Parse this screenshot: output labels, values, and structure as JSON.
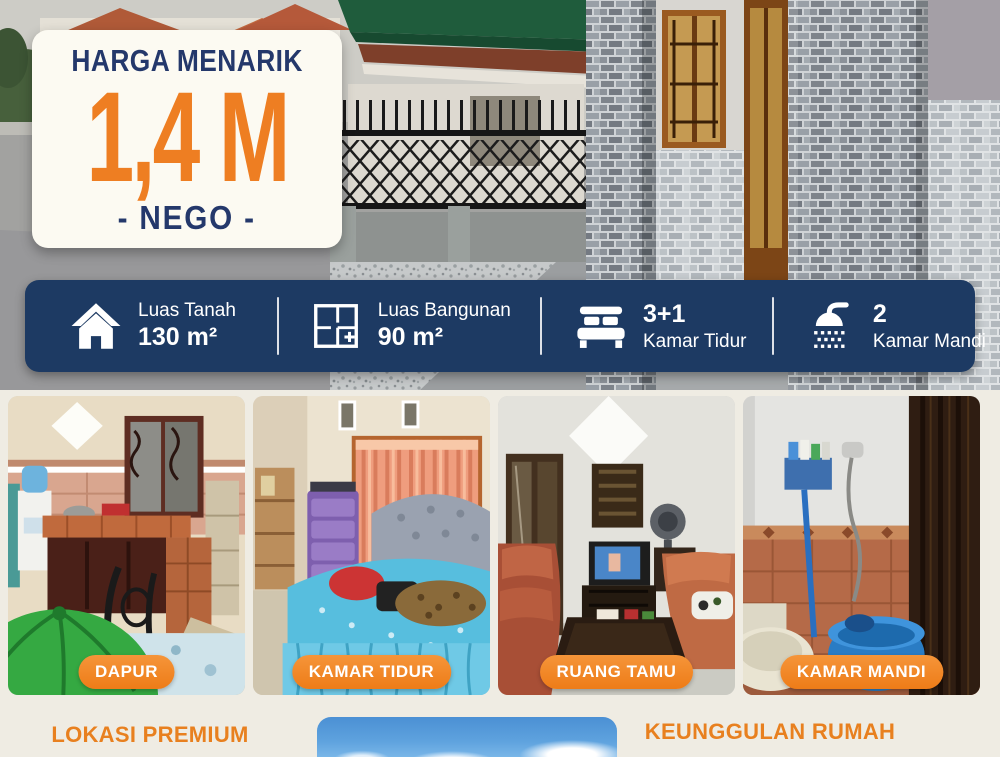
{
  "price_card": {
    "title": "HARGA MENARIK",
    "price": "1,4 M",
    "nego": "- NEGO -"
  },
  "info_bar": {
    "items": [
      {
        "icon": "house-icon",
        "label": "Luas Tanah",
        "value": "130 m²"
      },
      {
        "icon": "floorplan-icon",
        "label": "Luas Bangunan",
        "value": "90 m²"
      },
      {
        "icon": "bed-icon",
        "label": "Kamar Tidur",
        "value": "3+1"
      },
      {
        "icon": "shower-icon",
        "label": "Kamar Mandi",
        "value": "2"
      }
    ]
  },
  "rooms": [
    {
      "label": "DAPUR",
      "photo": "kitchen"
    },
    {
      "label": "KAMAR TIDUR",
      "photo": "bedroom"
    },
    {
      "label": "RUANG TAMU",
      "photo": "living-room"
    },
    {
      "label": "KAMAR MANDI",
      "photo": "bathroom"
    }
  ],
  "bottom": {
    "left_heading": "LOKASI PREMIUM",
    "right_heading": "KEUNGGULAN RUMAH"
  },
  "hero": {
    "photo": "house-exterior"
  },
  "colors": {
    "navy": "#1d3a63",
    "navy_text": "#24386b",
    "orange": "#ee7e22",
    "pill_orange": "#f1831f",
    "cream_background": "#efece3",
    "card_background": "#fcfaf2"
  }
}
